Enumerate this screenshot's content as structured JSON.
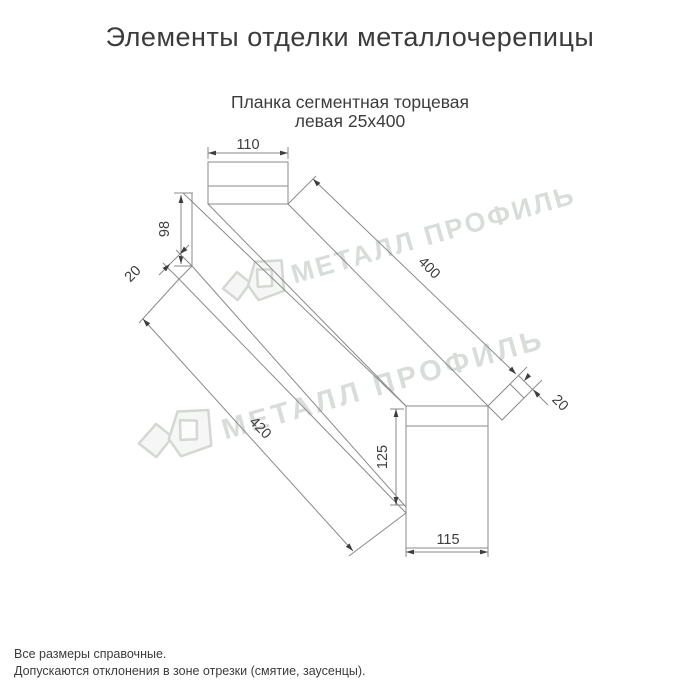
{
  "page": {
    "title": "Элементы отделки металлочерепицы",
    "subtitle_line1": "Планка сегментная торцевая",
    "subtitle_line2": "левая 25х400",
    "footer_line1": "Все размеры справочные.",
    "footer_line2": "Допускаются отклонения в зоне отрезки (смятие, заусенцы)."
  },
  "watermark": {
    "text": "МЕТАЛЛ ПРОФИЛЬ",
    "color": "#d9ddd9"
  },
  "drawing": {
    "part_name": "Планка сегментная торцевая левая 25х400",
    "dims": {
      "flange_top": "110",
      "height_left": "98",
      "flap_left": "20",
      "length_top": "400",
      "length_bottom": "420",
      "flap_right": "20",
      "height_right": "125",
      "width_right": "115"
    },
    "colors": {
      "line": "#8a8a8a",
      "dim_text": "#3e3e3e",
      "watermark": "#d9ddd9"
    }
  }
}
